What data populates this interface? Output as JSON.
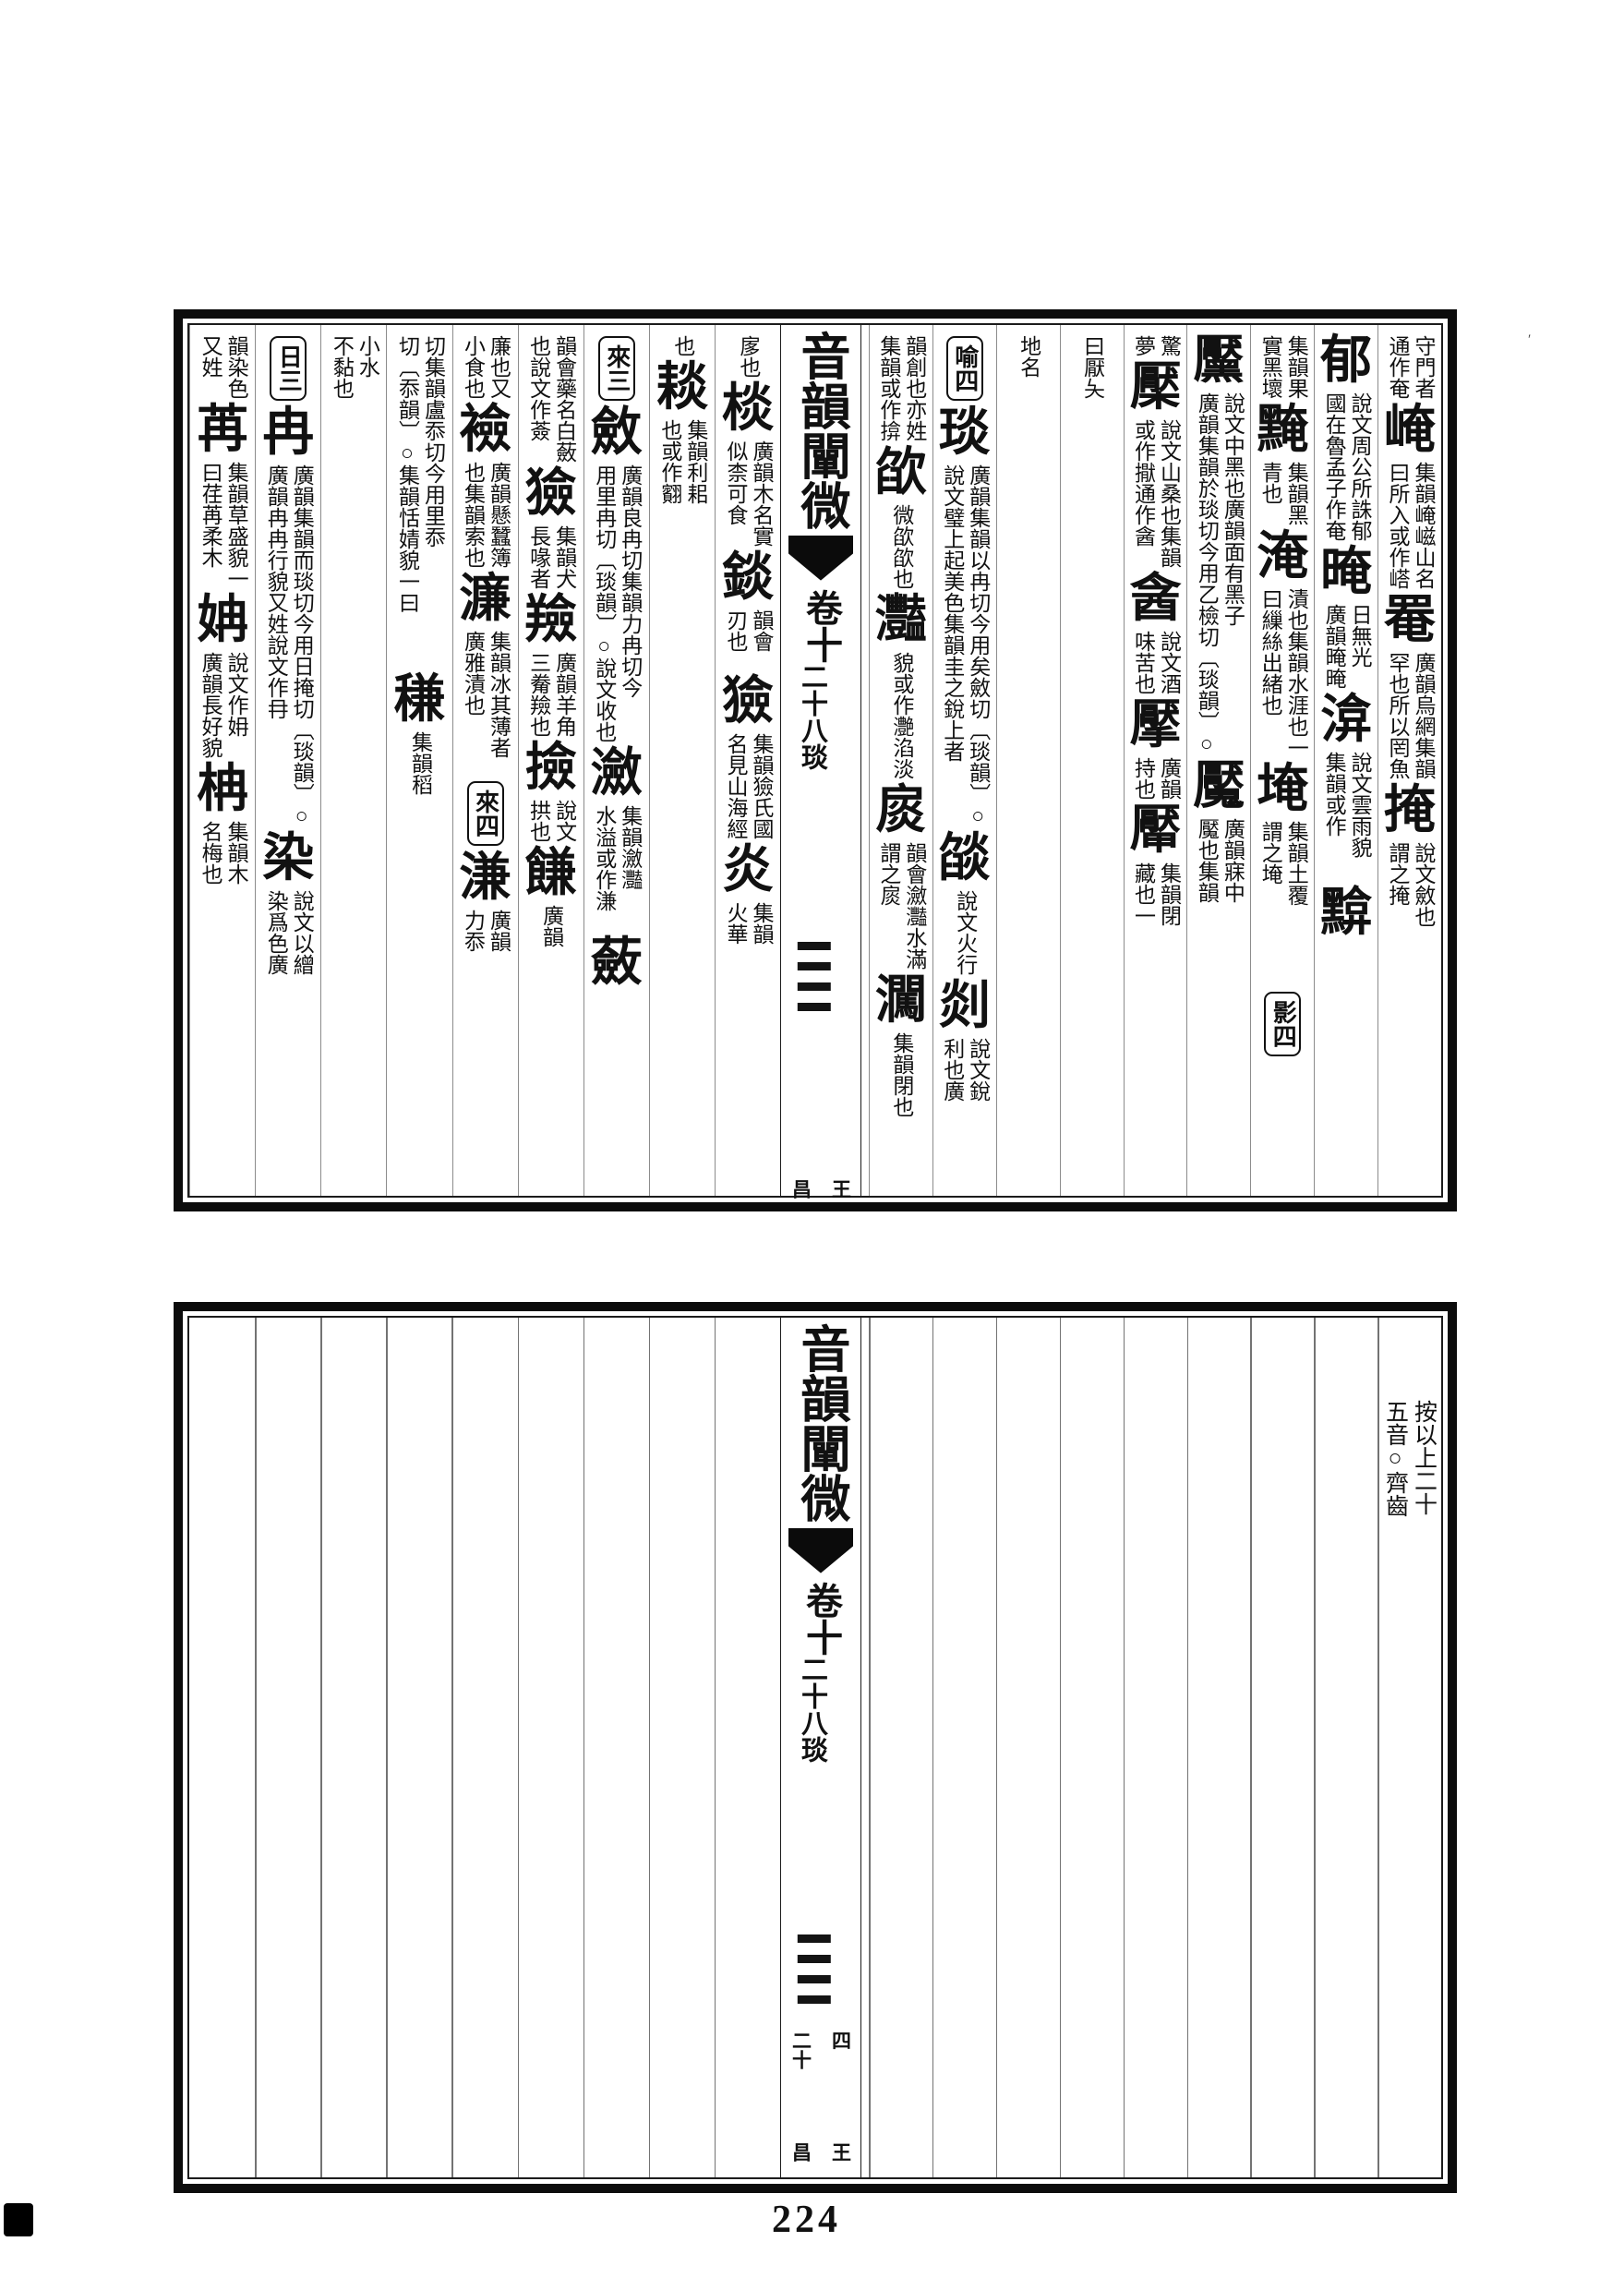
{
  "paper": "#ffffff",
  "ink": "#111111",
  "page_number": "224",
  "book": {
    "title": "音韻闡微",
    "volume": "卷十",
    "rhyme_label": "二十八琰"
  },
  "top_block": {
    "right_page_columns": [
      [
        {
          "t": "sm",
          "r": "守門者",
          "l": "通作奄"
        },
        {
          "t": "big",
          "c": "崦"
        },
        {
          "t": "sm",
          "r": "集韻崦嵫山名",
          "l": "曰所入或作㟷"
        },
        {
          "t": "big",
          "c": "罨"
        },
        {
          "t": "sm",
          "r": "廣韻烏網集韻",
          "l": "罕也所以罔魚"
        },
        {
          "t": "big",
          "c": "掩"
        },
        {
          "t": "sm",
          "r": "說文斂也",
          "l": "謂之掩"
        }
      ],
      [
        {
          "t": "big",
          "c": "郁"
        },
        {
          "t": "sm",
          "r": "說文周公所誅郁",
          "l": "國在魯孟子作奄"
        },
        {
          "t": "big",
          "c": "晻"
        },
        {
          "t": "sm",
          "r": "日無光",
          "l": "廣韻晻晻"
        },
        {
          "t": "big",
          "c": "渰"
        },
        {
          "t": "sm",
          "r": "說文雲雨貌",
          "l": "集韻或作𩃗"
        },
        {
          "t": "gap",
          "h": 26
        },
        {
          "t": "big",
          "c": "黭"
        }
      ],
      [
        {
          "t": "sm",
          "r": "集韻果",
          "l": "實黑壞"
        },
        {
          "t": "big",
          "c": "黤"
        },
        {
          "t": "sm",
          "r": "集韻黑",
          "l": "青也"
        },
        {
          "t": "big",
          "c": "淹"
        },
        {
          "t": "sm",
          "r": "漬也集韻水涯也一",
          "l": "曰繅絲出緒也"
        },
        {
          "t": "big",
          "c": "埯"
        },
        {
          "t": "sm",
          "r": "集韻土覆",
          "l": "謂之埯"
        },
        {
          "t": "gap",
          "h": 86
        },
        {
          "t": "box",
          "c": "影四"
        }
      ],
      [
        {
          "t": "big",
          "c": "黶"
        },
        {
          "t": "sm",
          "r": "說文中黑也廣韻面有黑子",
          "l": "廣韻集韻於琰切今用乙檢切〔琰韻〕○"
        },
        {
          "t": "big",
          "c": "魘"
        },
        {
          "t": "sm",
          "r": "廣韻寐中",
          "l": "魘也集韻"
        }
      ],
      [
        {
          "t": "sm",
          "r": "驚",
          "l": "夢"
        },
        {
          "t": "big",
          "c": "檿"
        },
        {
          "t": "sm",
          "r": "說文山桑也集韻",
          "l": "或作㩎通作酓"
        },
        {
          "t": "big",
          "c": "酓"
        },
        {
          "t": "sm",
          "r": "說文酒",
          "l": "味苦也"
        },
        {
          "t": "big",
          "c": "擪"
        },
        {
          "t": "sm",
          "r": "廣韻",
          "l": "持也"
        },
        {
          "t": "big",
          "c": "厴"
        },
        {
          "t": "sm",
          "r": "集韻閉",
          "l": "藏也一"
        }
      ],
      [
        {
          "t": "sm",
          "r": "曰厭夨",
          "l": ""
        }
      ],
      [
        {
          "t": "sm",
          "r": "地名",
          "l": ""
        }
      ],
      [
        {
          "t": "box",
          "c": "喻四"
        },
        {
          "t": "big",
          "c": "琰"
        },
        {
          "t": "sm",
          "r": "廣韻集韻以冉切今用矣斂切〔琰韻〕○",
          "l": "說文璧上起美色集韻圭之銳上者"
        },
        {
          "t": "big",
          "c": "燄"
        },
        {
          "t": "sm",
          "r": "說文火行",
          "l": ""
        },
        {
          "t": "big",
          "c": "剡"
        },
        {
          "t": "sm",
          "r": "說文銳",
          "l": "利也廣"
        }
      ],
      [
        {
          "t": "sm",
          "r": "韻創也亦姓",
          "l": "集韻或作揜"
        },
        {
          "t": "big",
          "c": "欿"
        },
        {
          "t": "sm",
          "r": "微欿欿也",
          "l": ""
        },
        {
          "t": "big",
          "c": "灩"
        },
        {
          "t": "sm",
          "r": "貌或作灔淊淡",
          "l": ""
        },
        {
          "t": "big",
          "c": "扊"
        },
        {
          "t": "sm",
          "r": "韻會瀲灩水滿",
          "l": "謂之扊"
        },
        {
          "t": "big",
          "c": "㶒"
        },
        {
          "t": "sm",
          "r": "集韻閉也",
          "l": ""
        }
      ]
    ],
    "left_page_columns": [
      [
        {
          "t": "sm",
          "r": "扅也",
          "l": ""
        },
        {
          "t": "big",
          "c": "棪"
        },
        {
          "t": "sm",
          "r": "廣韻木名實",
          "l": "似柰可食"
        },
        {
          "t": "big",
          "c": "錟"
        },
        {
          "t": "sm",
          "r": "韻會",
          "l": "刃也"
        },
        {
          "t": "gap",
          "h": 20
        },
        {
          "t": "big",
          "c": "獫"
        },
        {
          "t": "sm",
          "r": "集韻獫氏國",
          "l": "名見山海經"
        },
        {
          "t": "big",
          "c": "炎"
        },
        {
          "t": "sm",
          "r": "集韻",
          "l": "火華"
        }
      ],
      [
        {
          "t": "sm",
          "r": "也",
          "l": ""
        },
        {
          "t": "big",
          "c": "䎦"
        },
        {
          "t": "sm",
          "r": "集韻利耜",
          "l": "也或作䎙"
        }
      ],
      [
        {
          "t": "box",
          "c": "來三"
        },
        {
          "t": "big",
          "c": "斂"
        },
        {
          "t": "sm",
          "r": "廣韻良冉切集韻力冉切今",
          "l": "用里冉切〔琰韻〕○說文收也"
        },
        {
          "t": "big",
          "c": "瀲"
        },
        {
          "t": "sm",
          "r": "集韻瀲灩",
          "l": "水溢或作溓"
        },
        {
          "t": "gap",
          "h": 22
        },
        {
          "t": "big",
          "c": "蘞"
        }
      ],
      [
        {
          "t": "sm",
          "r": "韻會藥名白蘞",
          "l": "也說文作薟"
        },
        {
          "t": "big",
          "c": "獫"
        },
        {
          "t": "sm",
          "r": "集韻犬",
          "l": "長喙者"
        },
        {
          "t": "big",
          "c": "羷"
        },
        {
          "t": "sm",
          "r": "廣韻羊角",
          "l": "三觠羷也"
        },
        {
          "t": "big",
          "c": "撿"
        },
        {
          "t": "sm",
          "r": "說文",
          "l": "拱也"
        },
        {
          "t": "big",
          "c": "䭑"
        },
        {
          "t": "sm",
          "r": "廣韻",
          "l": ""
        }
      ],
      [
        {
          "t": "sm",
          "r": "廉也又",
          "l": "小食也"
        },
        {
          "t": "big",
          "c": "襝"
        },
        {
          "t": "sm",
          "r": "廣韻懸蠶簿",
          "l": "也集韻索也"
        },
        {
          "t": "big",
          "c": "濂"
        },
        {
          "t": "sm",
          "r": "集韻冰其薄者",
          "l": "廣雅漬也"
        },
        {
          "t": "gap",
          "h": 18
        },
        {
          "t": "box",
          "c": "來四"
        },
        {
          "t": "big",
          "c": "溓"
        },
        {
          "t": "sm",
          "r": "廣韻",
          "l": "力忝"
        }
      ],
      [
        {
          "t": "sm",
          "r": "切集韻盧忝切今用里忝",
          "l": "切〔忝韻〕○集韻恬婧貌一曰"
        },
        {
          "t": "gap",
          "h": 60
        },
        {
          "t": "big",
          "c": "稴"
        },
        {
          "t": "sm",
          "r": "集韻稻",
          "l": ""
        }
      ],
      [
        {
          "t": "sm",
          "r": "小水",
          "l": "不黏也"
        }
      ],
      [
        {
          "t": "box",
          "c": "日三"
        },
        {
          "t": "big",
          "c": "冉"
        },
        {
          "t": "sm",
          "r": "廣韻集韻而琰切今用日掩切〔琰韻〕○",
          "l": "廣韻冉冉行貌又姓說文作冄"
        },
        {
          "t": "big",
          "c": "染"
        },
        {
          "t": "sm",
          "r": "說文以繒",
          "l": "染爲色廣"
        }
      ],
      [
        {
          "t": "sm",
          "r": "韻染色",
          "l": "又姓"
        },
        {
          "t": "big",
          "c": "苒"
        },
        {
          "t": "sm",
          "r": "集韻草盛貌一",
          "l": "曰荏苒柔木"
        },
        {
          "t": "big",
          "c": "姌"
        },
        {
          "t": "sm",
          "r": "說文作㚩",
          "l": "廣韻長好貌"
        },
        {
          "t": "big",
          "c": "柟"
        },
        {
          "t": "sm",
          "r": "集韻木",
          "l": "名梅也"
        }
      ]
    ],
    "fold_marks": {
      "right": "王",
      "left": "昌"
    }
  },
  "bottom_block": {
    "note": {
      "right": "按以上二十",
      "l_label": "note-left-line",
      "left": "五音○齊齒"
    },
    "marks_upper": {
      "right": "四",
      "left": "二十"
    },
    "marks_lower": {
      "right": "王",
      "left": "昌"
    }
  }
}
